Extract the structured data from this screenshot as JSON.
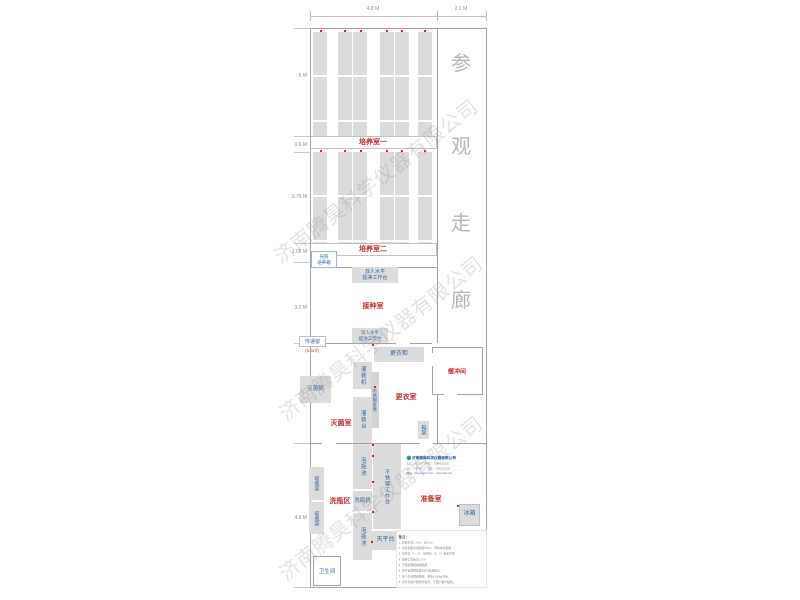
{
  "watermark": "济南腾昊科学仪器有限公司",
  "corridor": {
    "chars": [
      "参",
      "观",
      "走",
      "廊"
    ]
  },
  "dims": {
    "top": [
      "4.8 M",
      "2.1 M"
    ],
    "left": [
      "5 M",
      "0.6 M",
      "3.75 M",
      "1.05 M",
      "3.2 M",
      "4 M",
      "4.9 M"
    ]
  },
  "rooms": {
    "culture1": "培养室一",
    "culture2": "培养室二",
    "inoculation": "接种室",
    "sterilization": "灭菌室",
    "changing": "更衣室",
    "buffer": "缓冲间",
    "washing_area": "洗瓶区",
    "prep": "准备室",
    "toilet": "卫生间"
  },
  "equipment": {
    "clean_bench_l1": "双人水平",
    "clean_bench_l2": "超净工作台",
    "light_incubator_l1": "光照",
    "light_incubator_l2": "培养箱",
    "pass_window": "传递窗",
    "pass_window_area": "(0.4㎡)",
    "locker": "更衣柜",
    "filling_machine": "灌装机",
    "ss_bench": "不锈钢条凳",
    "filling_table": "灌装台",
    "sterilizer": "灭菌锅",
    "shoe_rack": "鞋架",
    "soak_pool": "泡瓶池",
    "worktable": "不锈钢工作台",
    "bottle_washer": "洗瓶机",
    "drying_rack": "晾瓶架",
    "balance_table": "天平台",
    "fridge": "冰箱"
  },
  "company": {
    "name": "济南腾昊科学仪器有限公司",
    "phone_line": "电话：0531-87799827、15866022552",
    "qq_line": "QQ：9747467　　微信：15866022552",
    "web_line": "网址：www.sqwt17.com　www.srtkj.com"
  },
  "notes": {
    "title": "备注：",
    "items": [
      "1. 培养架长1.25m，宽0.5m",
      "2. 培养架距离墙面留35cm，预留电源插座",
      "3. 培养室（1、2）、接种室（2、3）安装空调",
      "4. 接种工作台为1.0 M",
      "5. 灭菌锅预留电源插座",
      "6. 天平台预留插座380V电源接口",
      "7. 每个房间预留网线，承重±150kg平台",
      "8. 培养室窗户做遮光窗帘，不要小窗户贴膜。"
    ]
  }
}
